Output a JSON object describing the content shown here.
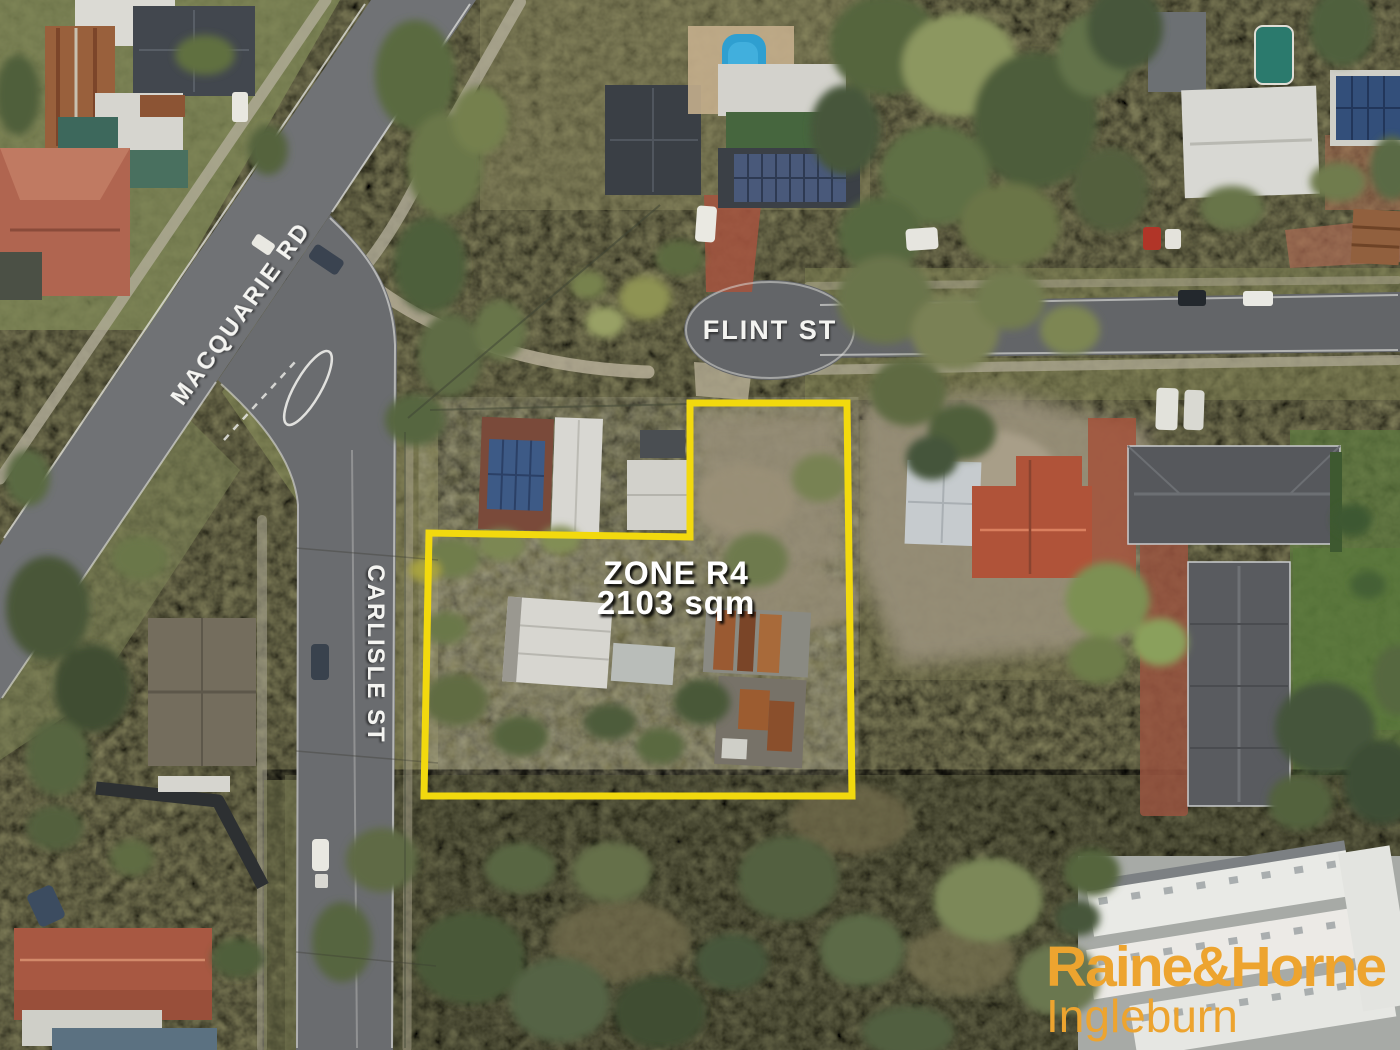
{
  "labels": {
    "macquarie": "MACQUARIE RD",
    "flint": "FLINT ST",
    "carlisle": "CARLISLE ST"
  },
  "property": {
    "zone_label": "ZONE R4",
    "area_label": "2103 sqm",
    "boundary_color": "#F2D90E"
  },
  "branding": {
    "name": "Raine&Horne",
    "office": "Ingleburn",
    "color": "#EDA42F"
  }
}
